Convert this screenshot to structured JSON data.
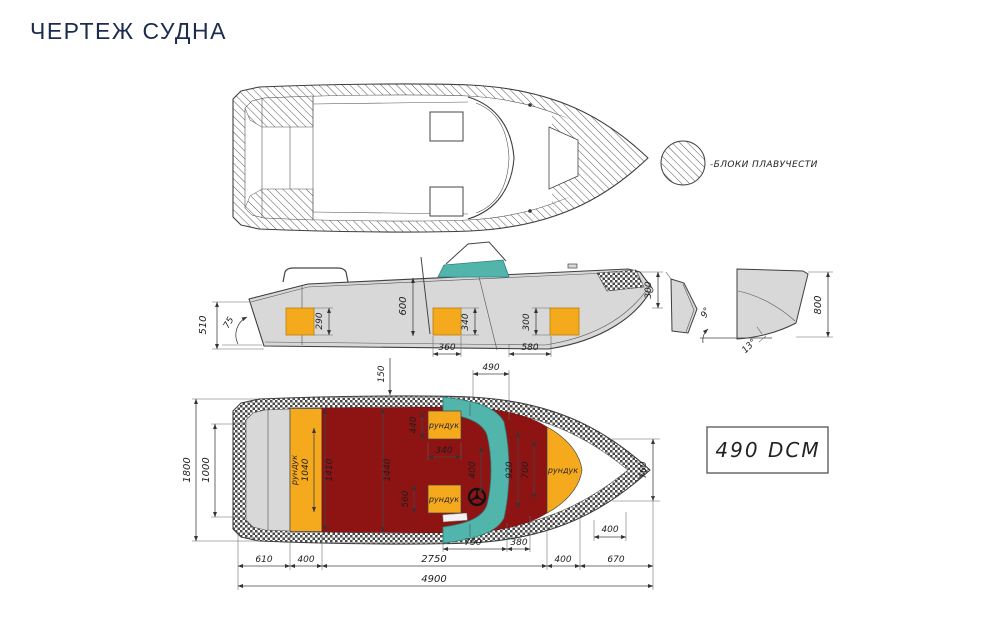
{
  "title": "ЧЕРТЕЖ СУДНА",
  "colors": {
    "title_navy": "#1c2b4e",
    "hull_gray": "#d8d8d8",
    "deck_red": "#8e1414",
    "locker_orange": "#f5a91d",
    "windshield_teal": "#52b5ac",
    "line": "#3f3f3f"
  },
  "legend": {
    "buoyancy_label": "-БЛОКИ ПЛАВУЧЕСТИ"
  },
  "scale_box": {
    "label": "490 DCM"
  },
  "deck_plan": {
    "locker_label": "рундук",
    "dims": {
      "windshield_offset": "150",
      "windshield_length": "490",
      "beam": "1800",
      "transom_width": "1000",
      "stern_locker_length": "1040",
      "cockpit_width_aft": "1410",
      "cockpit_width_mid": "1440",
      "seat_fwd_length": "440",
      "seat_width": "340",
      "walkthrough": "400",
      "seat_aft_length": "560",
      "bow_locker_length": "920",
      "bow_locker_inner": "700",
      "bow_width": "760",
      "bow_hatch_length": "400",
      "console_length": "750",
      "console_gap": "380",
      "stern_length": "610",
      "stern_locker_width": "400",
      "cockpit_length": "2750",
      "fwd_section": "400",
      "bow_length": "670",
      "overall_length": "4900"
    }
  },
  "side_view": {
    "dims": {
      "transom_height": "510",
      "transom_angle": "75",
      "stern_locker_height": "290",
      "cockpit_depth": "600",
      "mid_locker_height": "340",
      "fwd_locker_height": "300",
      "mid_locker_width": "360",
      "locker_spacing": "580",
      "bow_height": "300"
    }
  },
  "transom_section": {
    "dims": {
      "side_angle": "9°",
      "deadrise_angle": "13°",
      "height": "800"
    }
  }
}
